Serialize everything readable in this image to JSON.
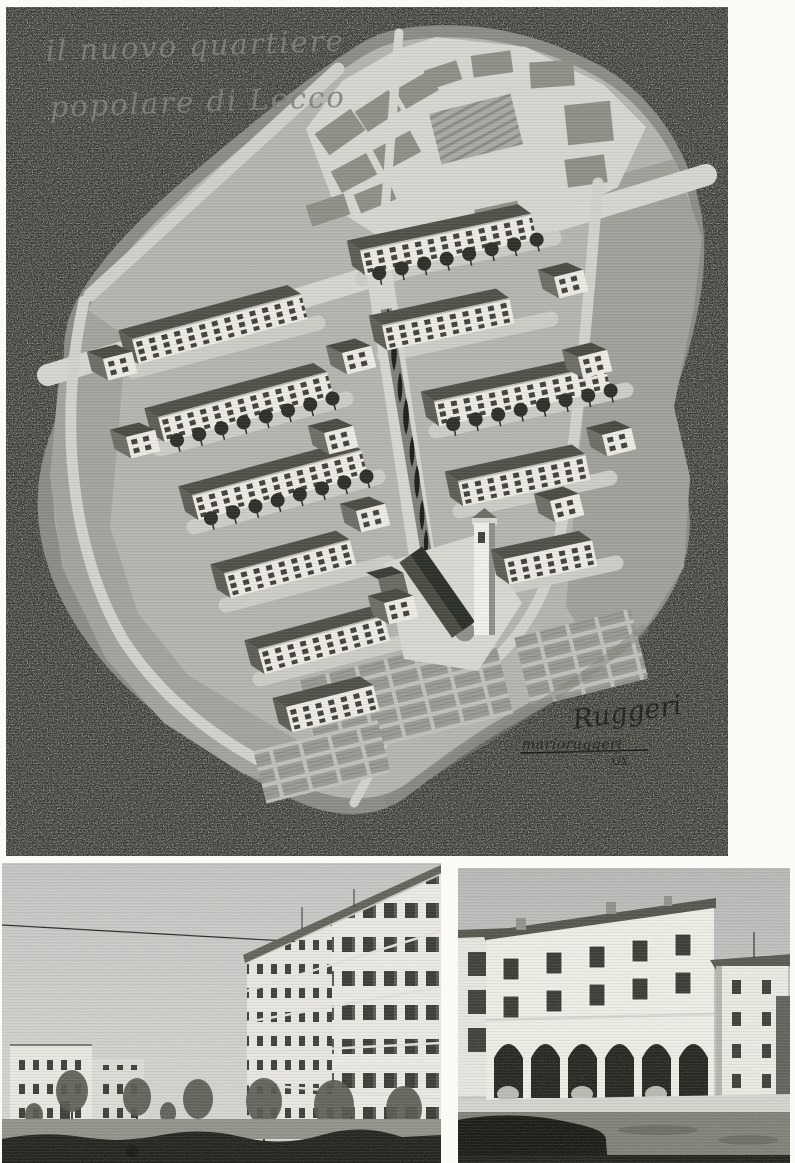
{
  "plate": {
    "caption": {
      "line1": "il nuovo quartiere",
      "line2": "popolare di Lecco"
    },
    "signature": {
      "flourish": "Ruggeri",
      "name": "marioruggeri",
      "year_roman": "XIX"
    }
  },
  "photos": {
    "left": {
      "semantic": "street-view-of-new-apartment-blocks-with-young-trees"
    },
    "right": {
      "semantic": "corner-building-with-ground-floor-arcade"
    }
  },
  "palette": {
    "page_white": "#fbfaf7",
    "plate_background": "#34362f",
    "plan_field": "#b4b5b0",
    "plan_rim": "#8b8d86",
    "street": "#d6d6d1",
    "roof_dark": "#50524a",
    "facade_white": "#eceae3",
    "foliage_dark": "#2a2c26",
    "photo_sky": "#c6c7c4",
    "photo_shadow": "#1c1e19"
  }
}
